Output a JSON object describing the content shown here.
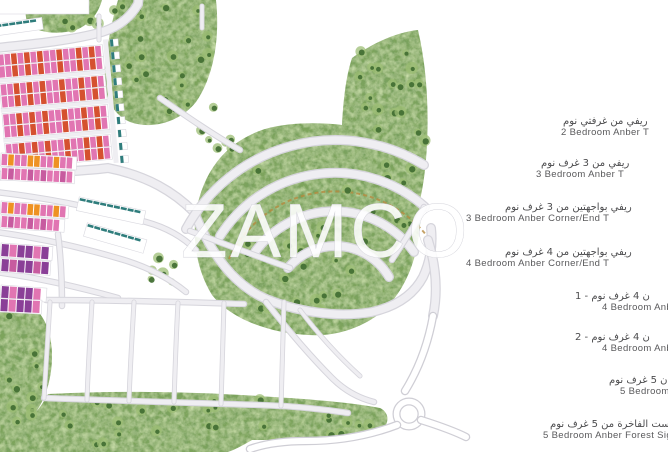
{
  "watermark": {
    "text": "ZAMCO"
  },
  "legend": {
    "items": [
      {
        "ar": "ريفي من غرفتي نوم",
        "en": "2 Bedroom Anber T"
      },
      {
        "ar": "ريفي من 3 غرف نوم",
        "en": "3 Bedroom Anber T"
      },
      {
        "ar": "ريفي بواجهتين من 3 غرف نوم",
        "en": "3 Bedroom Anber Corner/End T"
      },
      {
        "ar": "ريفي بواجهتين من 4 غرف نوم",
        "en": "4 Bedroom Anber Corner/End T"
      },
      {
        "ar": "ن 4 غرف نوم - 1",
        "en": "4 Bedroom Anb"
      },
      {
        "ar": "ن 4 غرف نوم - 2",
        "en": "4 Bedroom Anb"
      },
      {
        "ar": "ن 5 غرف نوم",
        "en": "5 Bedroom A"
      },
      {
        "ar": "وريست الفاخرة من 5 غرف نوم",
        "en": "5 Bedroom Anber Forest Sign"
      }
    ]
  },
  "palette": {
    "road": "#efeef2",
    "roadEdge": "#d6d5dc",
    "green": "#7da45c",
    "greenLight": "#9cbd74",
    "treeDark": "#3f6c31",
    "pink": "#e175b2",
    "magenta": "#c75b9f",
    "red": "#d5512f",
    "orange": "#ee9223",
    "orangeDark": "#cd6a18",
    "amber": "#f2c93e",
    "purple": "#8a3f97",
    "salmon": "#eeb08d",
    "salmonRoof": "#d8835a",
    "cream": "#ebd8a2",
    "creamRoof": "#cfa766",
    "teal": "#2f7d7c",
    "sand": "#dbcda3",
    "water": "#2e7a94",
    "waterMid": "#4e9ab2",
    "waterLight": "#82c2d6",
    "playBlue": "#3d55b2",
    "playRed": "#cf4434",
    "courtGreen": "#4c8f4c",
    "brick": "#a8412f",
    "dirt": "#b5893f",
    "white": "#ffffff"
  }
}
